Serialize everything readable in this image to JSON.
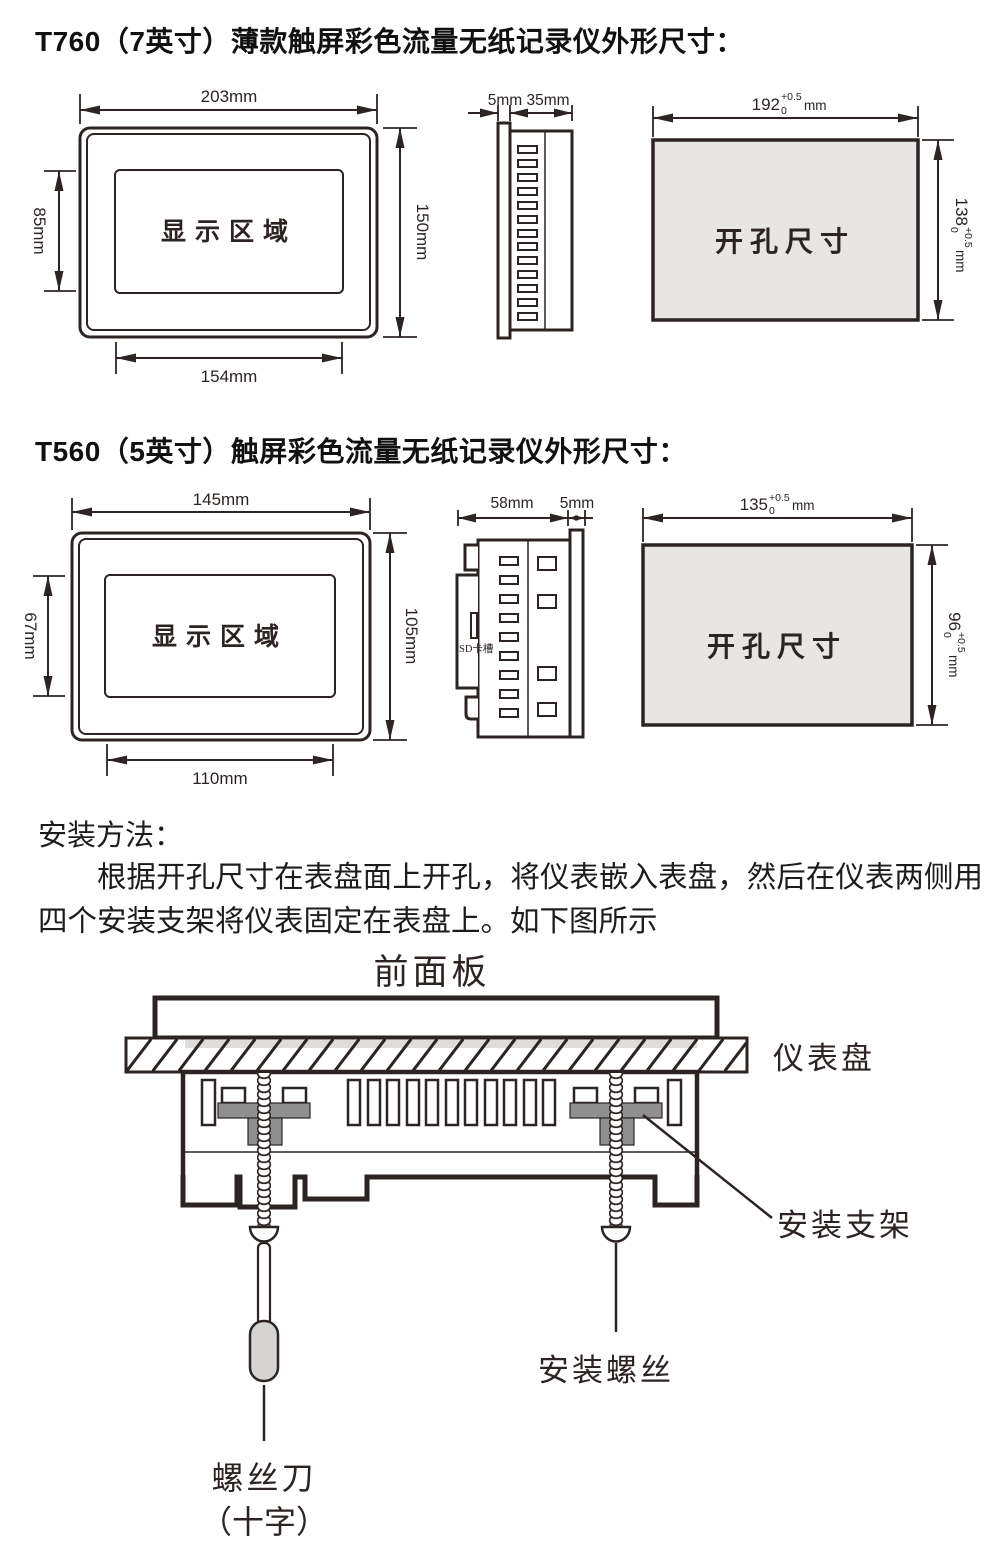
{
  "colors": {
    "line": "#2b2422",
    "cutout-fill": "#e7e6e5",
    "bracket-gray": "#8f8f8f",
    "handle-gray": "#d5d4d3",
    "strip-gray": "#dedddc",
    "title-text": "#111111"
  },
  "t760": {
    "title": "T760（7英寸）薄款触屏彩色流量无纸记录仪外形尺寸：",
    "front": {
      "display": "显示区域",
      "dim_width": "203mm",
      "dim_height": "150mm",
      "dim_disp_width": "154mm",
      "dim_disp_height": "85mm"
    },
    "side": {
      "dim_bezel": "5mm",
      "dim_depth": "35mm"
    },
    "cutout": {
      "text": "开孔尺寸",
      "w_base": "192",
      "w_sup": "+0.5",
      "w_sub": "0",
      "w_unit": "mm",
      "h_base": "138",
      "h_sup": "+0.5",
      "h_sub": "0",
      "h_unit": "mm"
    }
  },
  "t560": {
    "title": "T560（5英寸）触屏彩色流量无纸记录仪外形尺寸：",
    "front": {
      "display": "显示区域",
      "dim_width": "145mm",
      "dim_height": "105mm",
      "dim_disp_width": "110mm",
      "dim_disp_height": "67mm"
    },
    "side": {
      "dim_depth": "58mm",
      "dim_bezel": "5mm",
      "sd_label": "SD卡槽"
    },
    "cutout": {
      "text": "开孔尺寸",
      "w_base": "135",
      "w_sup": "+0.5",
      "w_sub": "0",
      "w_unit": "mm",
      "h_base": "96",
      "h_sup": "+0.5",
      "h_sub": "0",
      "h_unit": "mm"
    }
  },
  "install": {
    "heading": "安装方法：",
    "paragraph": "根据开孔尺寸在表盘面上开孔，将仪表嵌入表盘，然后在仪表两侧用四个安装支架将仪表固定在表盘上。如下图所示",
    "label_front_panel": "前面板",
    "label_panel": "仪表盘",
    "label_bracket": "安装支架",
    "label_screw": "安装螺丝",
    "label_screwdriver_1": "螺丝刀",
    "label_screwdriver_2": "（十字）"
  }
}
